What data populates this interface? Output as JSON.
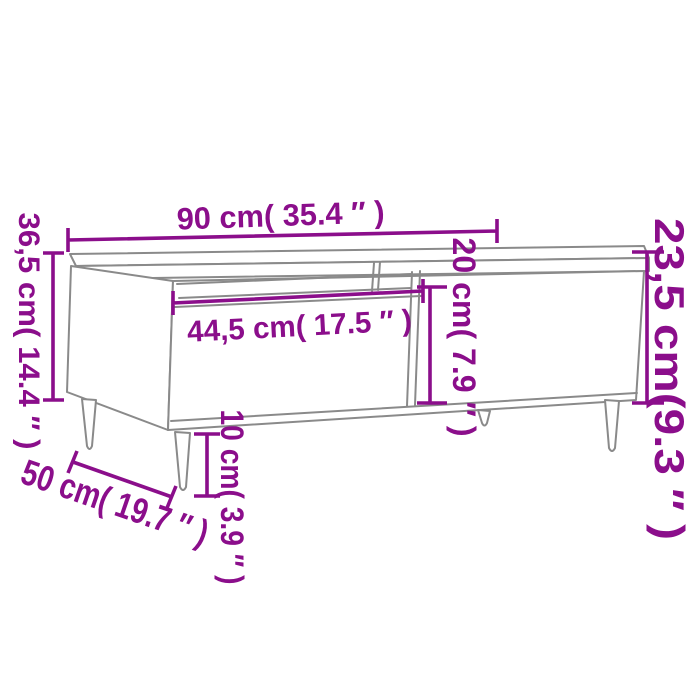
{
  "diagram": {
    "type": "product-dimension-diagram",
    "subject": "coffee-table",
    "background_color": "#ffffff",
    "colors": {
      "dimension_accent": "#8b0e8b",
      "furniture_lines": "#8a8a8a"
    },
    "labels": {
      "width": "90 cm( 35.4 ″ )",
      "total_height": "36,5 cm( 14.4 ″ )",
      "drawer_width": "44,5 cm( 17.5 ″ )",
      "front_panel_height": "20 cm( 7.9 ″ )",
      "body_height": "23,5 cm(9.3 ″ )",
      "leg_height": "10 cm( 3.9 ″ )",
      "depth": "50 cm( 19.7 ″ )"
    }
  }
}
